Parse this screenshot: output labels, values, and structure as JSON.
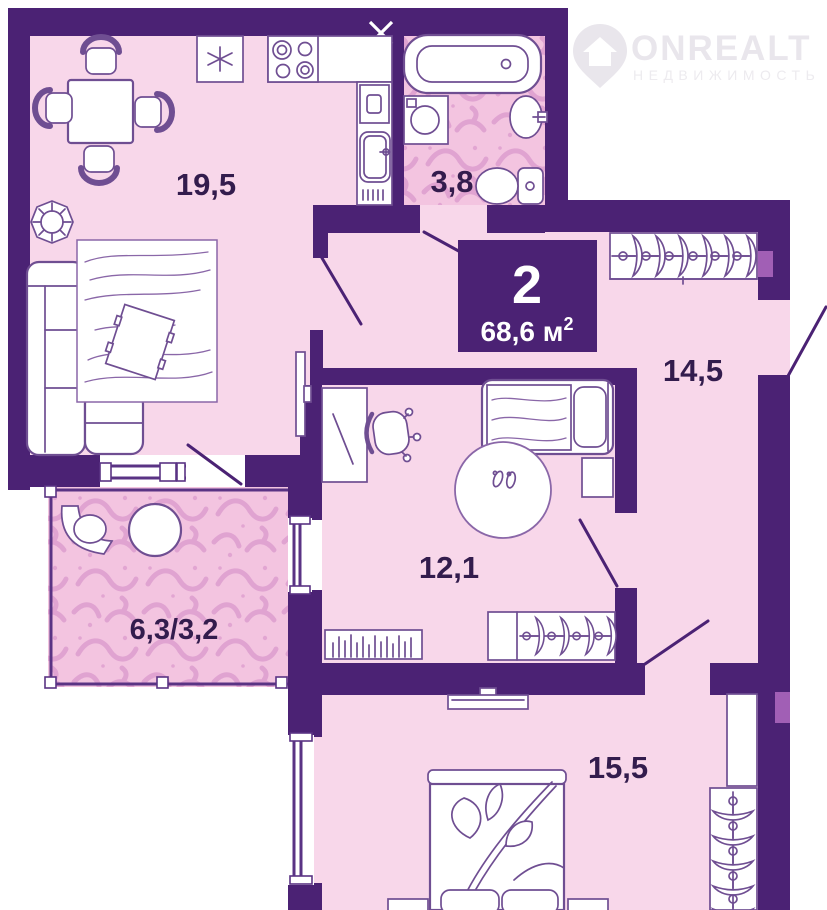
{
  "plan": {
    "title_badge": {
      "rooms_count": "2",
      "area_main": "68,6 м",
      "area_sup": "2"
    },
    "rooms": {
      "kitchen_living": {
        "area": "19,5"
      },
      "bathroom": {
        "area": "3,8"
      },
      "hallway": {
        "area": "14,5"
      },
      "room": {
        "area": "12,1"
      },
      "balcony": {
        "area": "6,3/3,2"
      },
      "bedroom": {
        "area": "15,5"
      }
    }
  },
  "logo": {
    "title": "ONREALT",
    "subtitle": "НЕДВИЖИМОСТЬ"
  },
  "colors": {
    "wall": "#4b2274",
    "floor_pink": "#f8d7ea",
    "pattern_base": "#f3c4e0",
    "pattern_swirl": "#dd9ecf",
    "accent_light_purple": "#a15fb5",
    "badge_background": "#4b2274",
    "label_text": "#331c4d",
    "furniture_stroke": "#6f4e92",
    "logo_gray": "#e9e6ec"
  }
}
